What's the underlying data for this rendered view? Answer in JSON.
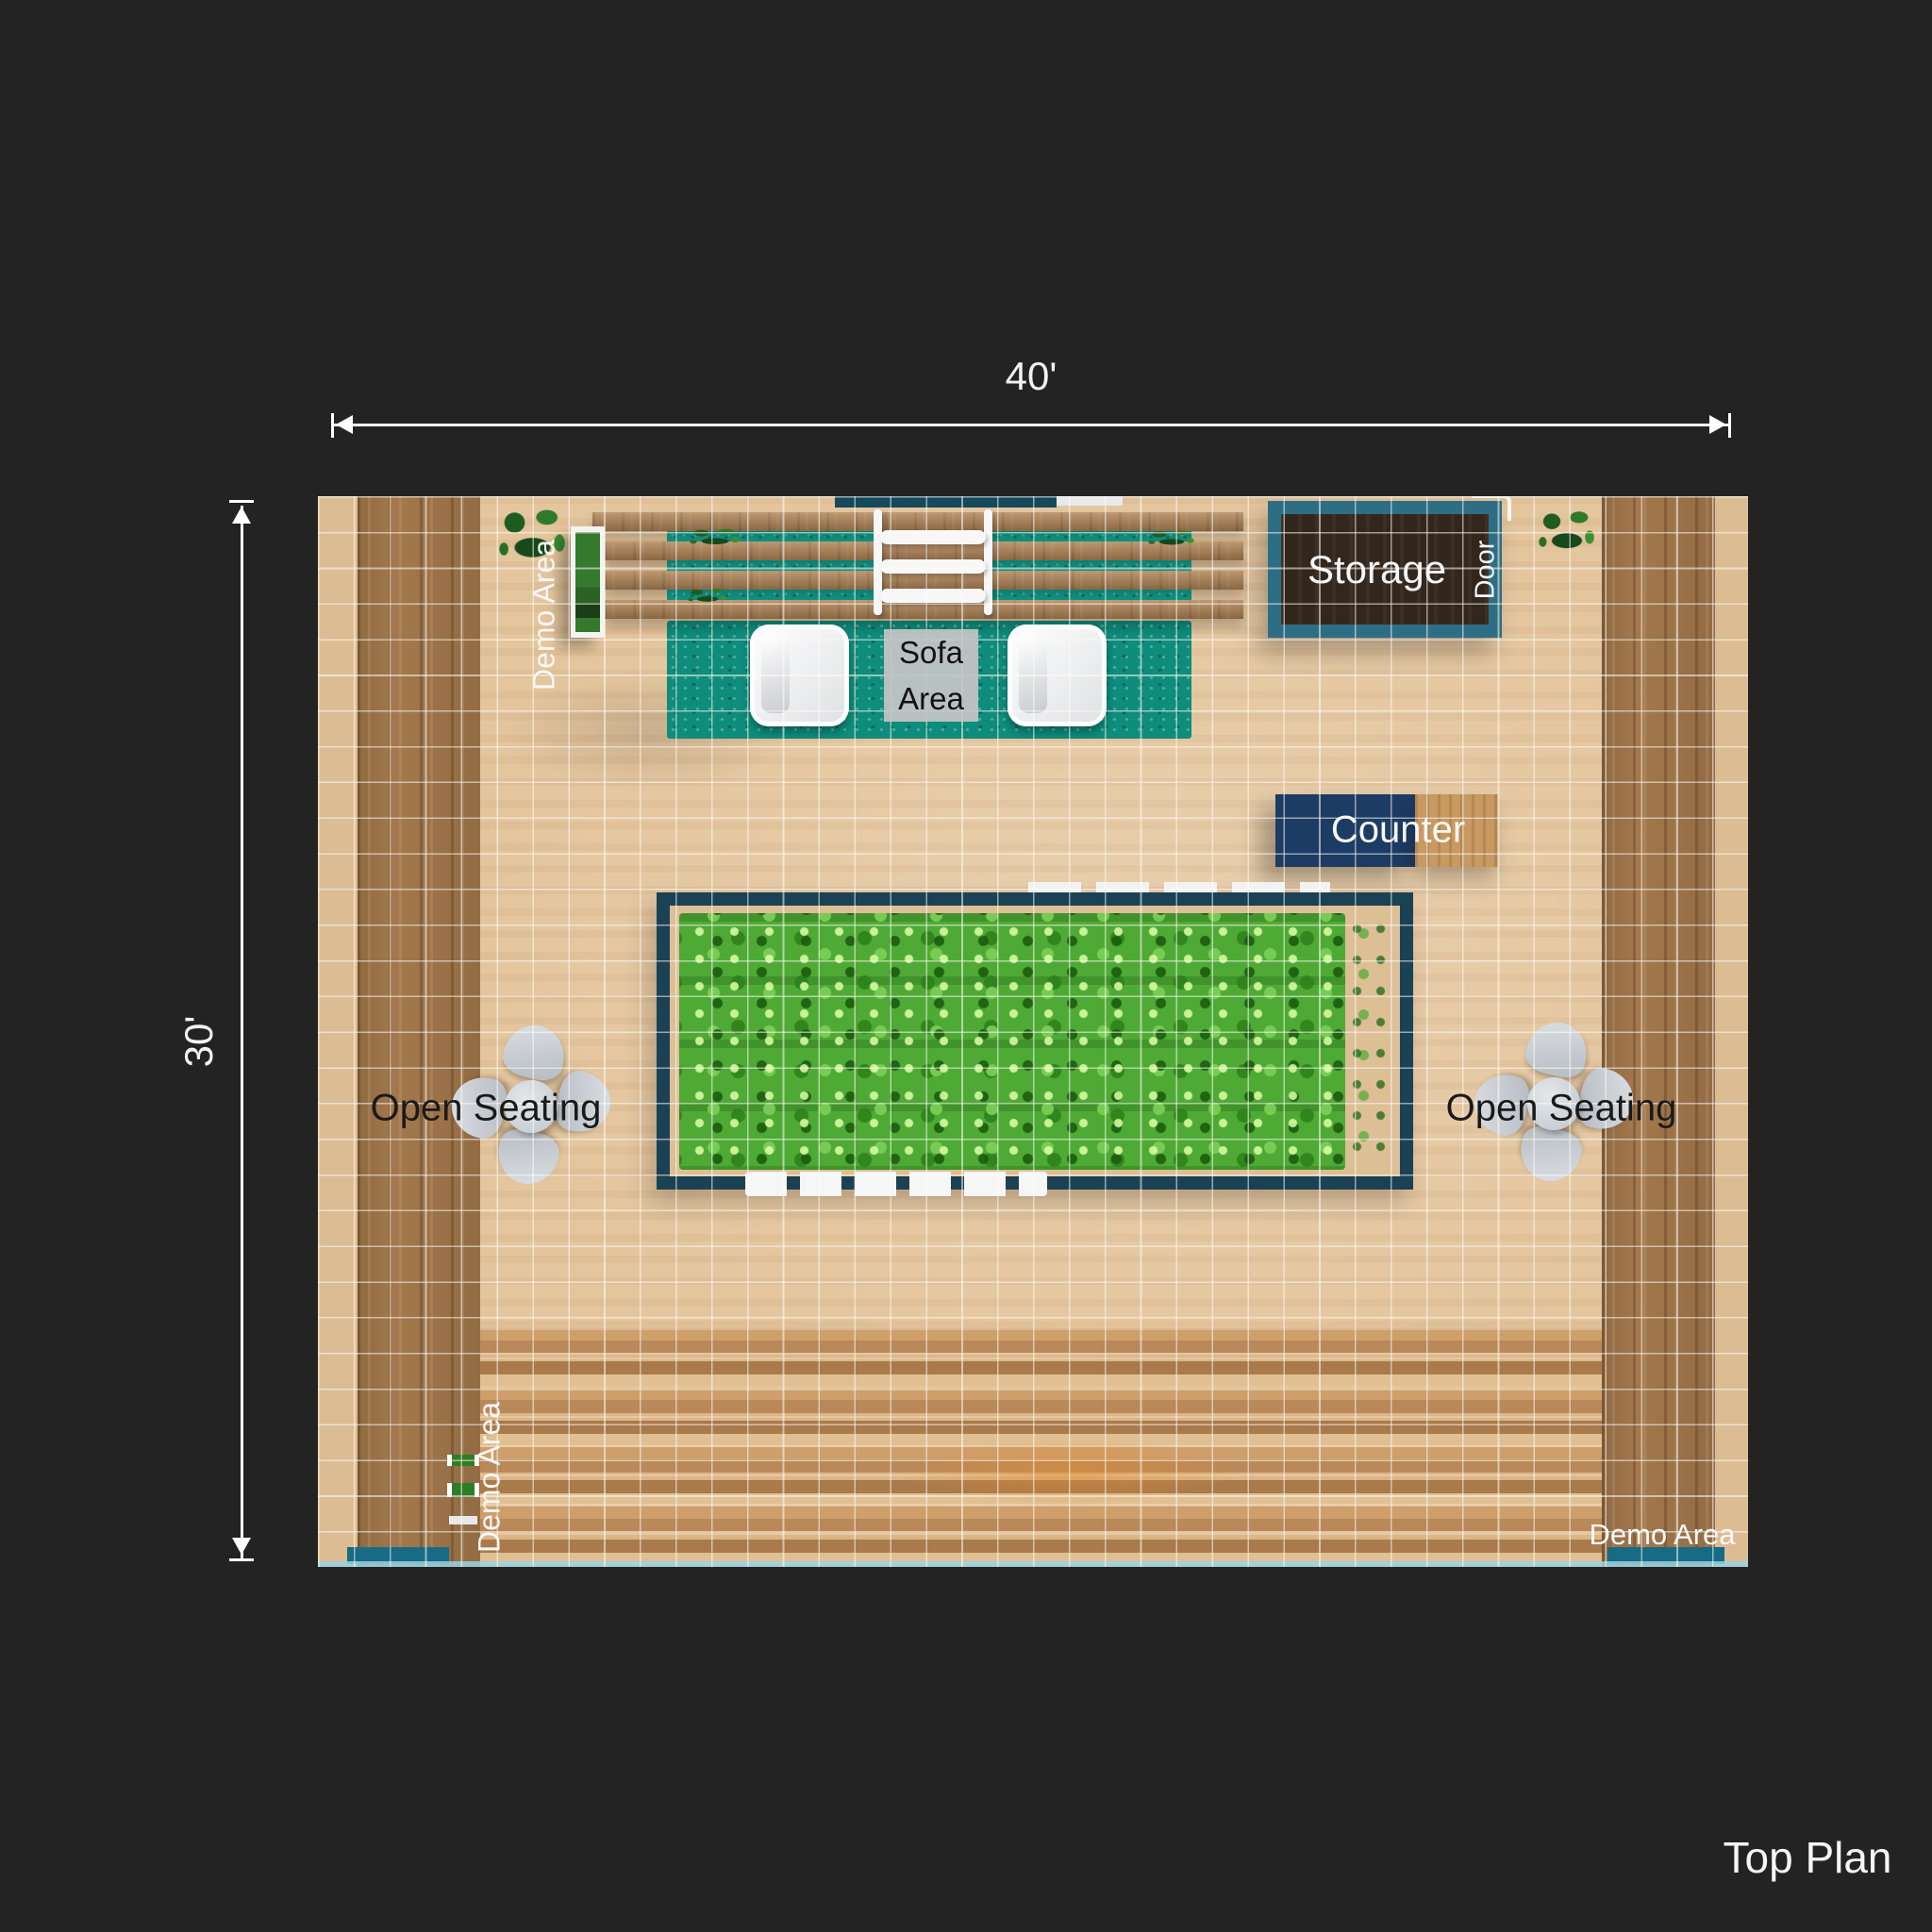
{
  "title": {
    "label": "Top Plan"
  },
  "dimensions": {
    "width": "40'",
    "depth": "30'"
  },
  "labels": {
    "storage": "Storage",
    "door": "Door",
    "sofa_area": "Sofa Area",
    "counter": "Counter",
    "open_seating_left": "Open Seating",
    "open_seating_right": "Open Seating",
    "demo_area_top_left": "Demo Area",
    "demo_area_bottom_left": "Demo Area",
    "demo_area_bottom_right": "Demo Area"
  },
  "colors": {
    "background": "#232323",
    "floor_wood": "#e4c69e",
    "wall_wood_dark": "#a3784c",
    "rug_teal": "#0e8c7c",
    "storage_border_teal": "#2d6e84",
    "storage_interior_brown": "#33271d",
    "counter_navy": "#1d3c63",
    "planter_border_navy": "#1b4154",
    "foliage_green": "#4faa35",
    "chair_gray": "#c7cdd3",
    "dimension_line_white": "#ffffff"
  }
}
